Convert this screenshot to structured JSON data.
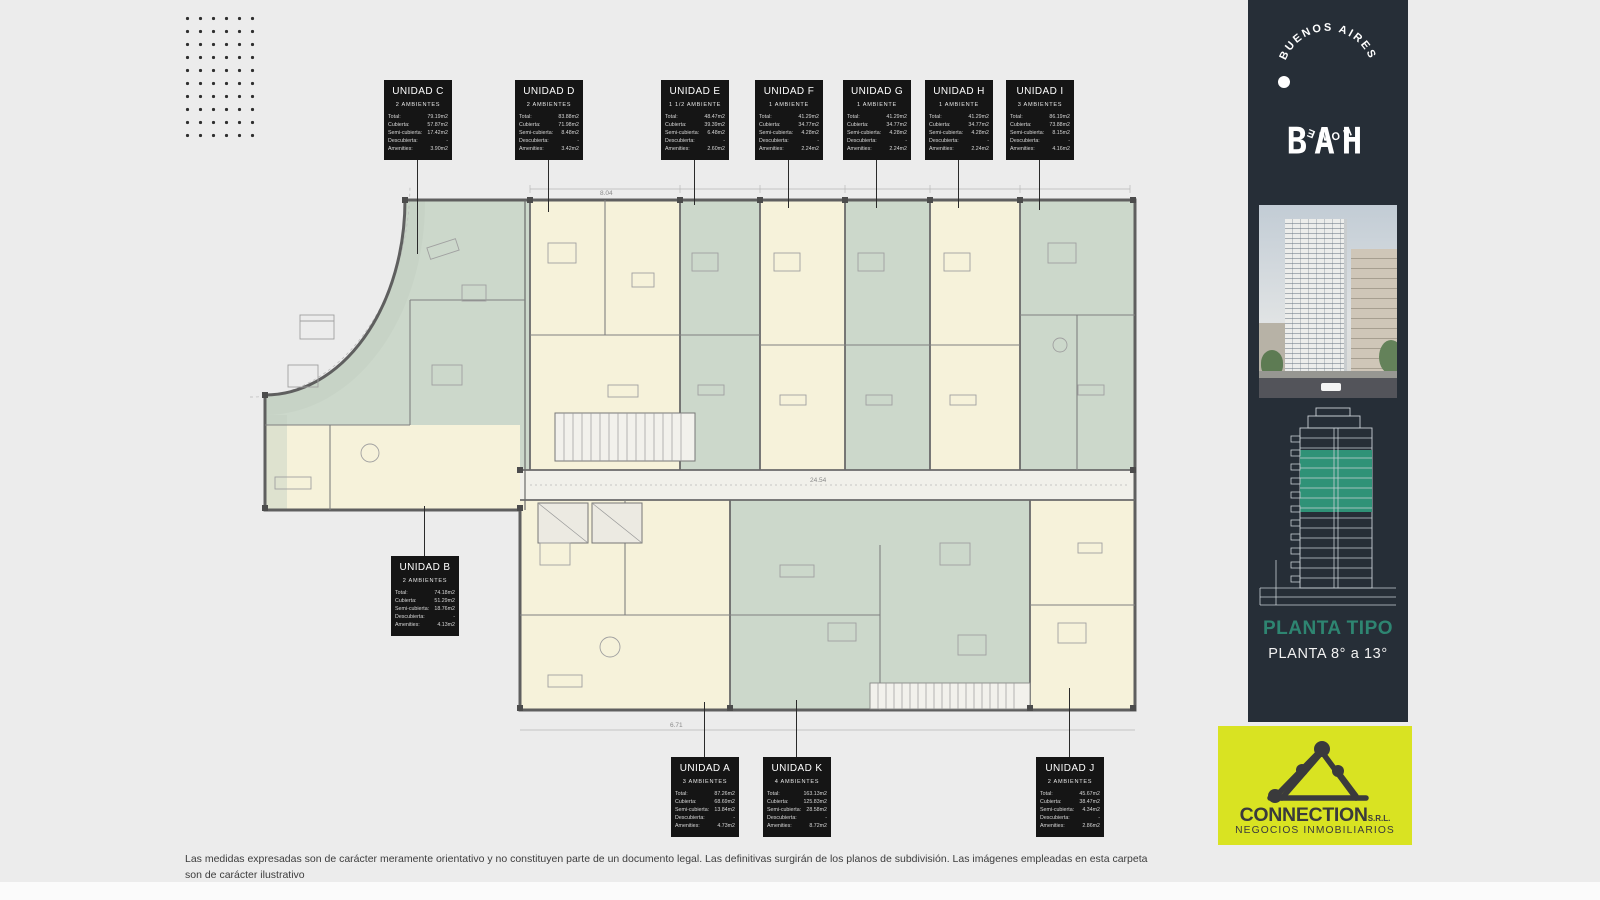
{
  "page": {
    "background": "#ececec",
    "disclaimer_line1": "Las medidas expresadas son de carácter meramente orientativo y no constituyen parte de un documento legal. Las definitivas surgirán de los planos de subdivisión. Las imágenes empleadas en esta carpeta",
    "disclaimer_line2": "son de carácter ilustrativo"
  },
  "fields": {
    "total": "Total:",
    "cubierta": "Cubierta:",
    "semi_cubierta": "Semi-cubierta:",
    "descubierta": "Descubierta:",
    "amenities": "Amenities:"
  },
  "units": [
    {
      "id": "C",
      "name": "UNIDAD C",
      "ambientes": "2 AMBIENTES",
      "total": "79.19m2",
      "cubierta": "57.87m2",
      "semi": "17.42m2",
      "desc": "-",
      "amen": "3.90m2"
    },
    {
      "id": "D",
      "name": "UNIDAD D",
      "ambientes": "2 AMBIENTES",
      "total": "83.88m2",
      "cubierta": "71.98m2",
      "semi": "8.48m2",
      "desc": "-",
      "amen": "3.42m2"
    },
    {
      "id": "E",
      "name": "UNIDAD E",
      "ambientes": "1 1/2 AMBIENTE",
      "total": "48.47m2",
      "cubierta": "39.39m2",
      "semi": "6.48m2",
      "desc": "-",
      "amen": "2.60m2"
    },
    {
      "id": "F",
      "name": "UNIDAD F",
      "ambientes": "1 AMBIENTE",
      "total": "41.29m2",
      "cubierta": "34.77m2",
      "semi": "4.28m2",
      "desc": "-",
      "amen": "2.24m2"
    },
    {
      "id": "G",
      "name": "UNIDAD G",
      "ambientes": "1 AMBIENTE",
      "total": "41.29m2",
      "cubierta": "34.77m2",
      "semi": "4.28m2",
      "desc": "-",
      "amen": "2.24m2"
    },
    {
      "id": "H",
      "name": "UNIDAD H",
      "ambientes": "1 AMBIENTE",
      "total": "41.29m2",
      "cubierta": "34.77m2",
      "semi": "4.28m2",
      "desc": "-",
      "amen": "2.24m2"
    },
    {
      "id": "I",
      "name": "UNIDAD I",
      "ambientes": "3 AMBIENTES",
      "total": "86.19m2",
      "cubierta": "73.88m2",
      "semi": "8.15m2",
      "desc": "-",
      "amen": "4.16m2"
    },
    {
      "id": "B",
      "name": "UNIDAD B",
      "ambientes": "2 AMBIENTES",
      "total": "74.18m2",
      "cubierta": "51.29m2",
      "semi": "18.76m2",
      "desc": "-",
      "amen": "4.13m2"
    },
    {
      "id": "A",
      "name": "UNIDAD A",
      "ambientes": "3 AMBIENTES",
      "total": "87.26m2",
      "cubierta": "68.69m2",
      "semi": "13.84m2",
      "desc": "-",
      "amen": "4.73m2"
    },
    {
      "id": "K",
      "name": "UNIDAD K",
      "ambientes": "4 AMBIENTES",
      "total": "163.13m2",
      "cubierta": "125.83m2",
      "semi": "28.58m2",
      "desc": "-",
      "amen": "8.72m2"
    },
    {
      "id": "J",
      "name": "UNIDAD J",
      "ambientes": "2 AMBIENTES",
      "total": "45.67m2",
      "cubierta": "38.47m2",
      "semi": "4.34m2",
      "desc": "-",
      "amen": "2.86m2"
    }
  ],
  "sidebar": {
    "ring_top": "BUENOS AIRES",
    "ring_bottom": "HOME",
    "logo": "BAH",
    "plan_title": "PLANTA TIPO",
    "plan_subtitle": "PLANTA 8° a 13°",
    "colors": {
      "bar": "#262e37",
      "accent": "#2e8571",
      "floors_highlight": "#2f9277"
    }
  },
  "connection": {
    "name": "CONNECTION",
    "suffix": "S.R.L.",
    "tagline": "NEGOCIOS INMOBILIARIOS",
    "colors": {
      "background": "#d9e322",
      "foreground": "#3a3a3c"
    }
  },
  "plan": {
    "dim_top": "8.04",
    "dim_corridor": "24.54",
    "dim_bottom": "6.71",
    "colors": {
      "cream": "#f6f2da",
      "sage": "#ccd8cb",
      "wall": "#5f5f5f",
      "corridor": "#f1f0ea"
    }
  }
}
